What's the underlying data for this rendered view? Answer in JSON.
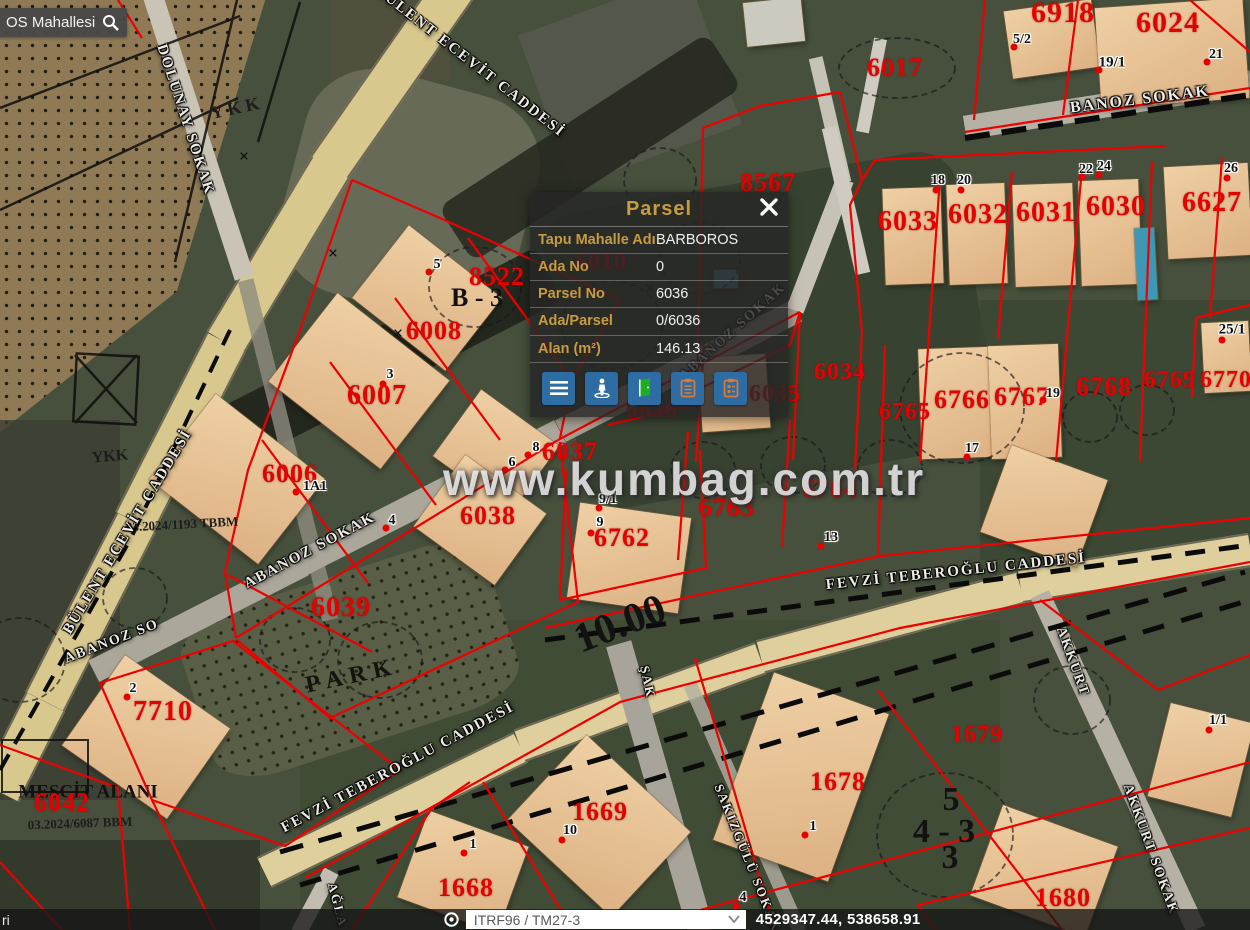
{
  "search": {
    "text": "OS Mahallesi"
  },
  "popup": {
    "title": "Parsel",
    "accent_color": "#c79b3f",
    "button_color": "#2e6da4",
    "rows": [
      {
        "label": "Tapu Mahalle Adı",
        "value": "BARBOROS"
      },
      {
        "label": "Ada No",
        "value": "0"
      },
      {
        "label": "Parsel No",
        "value": "6036"
      },
      {
        "label": "Ada/Parsel",
        "value": "0/6036"
      },
      {
        "label": "Alan (m²)",
        "value": "146.13"
      }
    ],
    "buttons": [
      {
        "name": "menu-button",
        "icon": "hamburger-icon"
      },
      {
        "name": "street-view-button",
        "icon": "pegman-icon"
      },
      {
        "name": "door-button",
        "icon": "door-icon"
      },
      {
        "name": "clipboard-button",
        "icon": "clipboard-icon"
      },
      {
        "name": "report-button",
        "icon": "clipboard-list-icon"
      }
    ]
  },
  "statusbar": {
    "left_fragment": "ri",
    "crs_selector": "ITRF96 / TM27-3",
    "coordinates": "4529347.44, 538658.91"
  },
  "watermark": {
    "text": "www.kumbag.com.tr"
  },
  "map": {
    "parcel_labels": [
      {
        "t": "6918",
        "x": 1063,
        "y": 13,
        "s": 30
      },
      {
        "t": "6024",
        "x": 1168,
        "y": 23,
        "s": 30
      },
      {
        "t": "6017",
        "x": 895,
        "y": 68,
        "s": 26
      },
      {
        "t": "8567",
        "x": 768,
        "y": 183,
        "s": 26
      },
      {
        "t": "6033",
        "x": 908,
        "y": 222,
        "s": 28
      },
      {
        "t": "6032",
        "x": 978,
        "y": 215,
        "s": 28
      },
      {
        "t": "6031",
        "x": 1046,
        "y": 213,
        "s": 28
      },
      {
        "t": "6030",
        "x": 1116,
        "y": 207,
        "s": 28
      },
      {
        "t": "6627",
        "x": 1212,
        "y": 203,
        "s": 28
      },
      {
        "t": "6010",
        "x": 601,
        "y": 262,
        "s": 24
      },
      {
        "t": "8522",
        "x": 497,
        "y": 277,
        "s": 26
      },
      {
        "t": "6008",
        "x": 434,
        "y": 331,
        "s": 26
      },
      {
        "t": "6007",
        "x": 377,
        "y": 396,
        "s": 28
      },
      {
        "t": "6006",
        "x": 290,
        "y": 474,
        "s": 26
      },
      {
        "t": "6034",
        "x": 840,
        "y": 372,
        "s": 24
      },
      {
        "t": "6035",
        "x": 775,
        "y": 394,
        "s": 24
      },
      {
        "t": "6036",
        "x": 652,
        "y": 410,
        "s": 24
      },
      {
        "t": "6765",
        "x": 905,
        "y": 412,
        "s": 24
      },
      {
        "t": "6766",
        "x": 962,
        "y": 400,
        "s": 26
      },
      {
        "t": "6767",
        "x": 1022,
        "y": 397,
        "s": 26
      },
      {
        "t": "6768",
        "x": 1104,
        "y": 387,
        "s": 26
      },
      {
        "t": "6769",
        "x": 1170,
        "y": 380,
        "s": 24
      },
      {
        "t": "6770",
        "x": 1226,
        "y": 380,
        "s": 24
      },
      {
        "t": "6037",
        "x": 570,
        "y": 452,
        "s": 26
      },
      {
        "t": "6038",
        "x": 488,
        "y": 516,
        "s": 26
      },
      {
        "t": "6762",
        "x": 622,
        "y": 538,
        "s": 26
      },
      {
        "t": "6763",
        "x": 727,
        "y": 508,
        "s": 26
      },
      {
        "t": "6764",
        "x": 830,
        "y": 489,
        "s": 26
      },
      {
        "t": "6039",
        "x": 341,
        "y": 608,
        "s": 28
      },
      {
        "t": "7710",
        "x": 163,
        "y": 712,
        "s": 28
      },
      {
        "t": "6042",
        "x": 62,
        "y": 803,
        "s": 26
      },
      {
        "t": "1669",
        "x": 600,
        "y": 812,
        "s": 26
      },
      {
        "t": "1668",
        "x": 466,
        "y": 888,
        "s": 26
      },
      {
        "t": "1678",
        "x": 838,
        "y": 782,
        "s": 26
      },
      {
        "t": "1679",
        "x": 977,
        "y": 735,
        "s": 24
      },
      {
        "t": "1680",
        "x": 1063,
        "y": 898,
        "s": 26
      }
    ],
    "house_numbers": [
      {
        "t": "5/2",
        "x": 1022,
        "y": 40,
        "s": 14
      },
      {
        "t": "21",
        "x": 1216,
        "y": 55,
        "s": 14
      },
      {
        "t": "19/1",
        "x": 1112,
        "y": 63,
        "s": 15
      },
      {
        "t": "18",
        "x": 938,
        "y": 181,
        "s": 14
      },
      {
        "t": "20",
        "x": 964,
        "y": 181,
        "s": 14
      },
      {
        "t": "22",
        "x": 1086,
        "y": 170,
        "s": 14
      },
      {
        "t": "24",
        "x": 1104,
        "y": 167,
        "s": 14
      },
      {
        "t": "26",
        "x": 1231,
        "y": 169,
        "s": 14
      },
      {
        "t": "25/1",
        "x": 1232,
        "y": 330,
        "s": 15
      },
      {
        "t": "19",
        "x": 1053,
        "y": 394,
        "s": 14
      },
      {
        "t": "17",
        "x": 972,
        "y": 449,
        "s": 14
      },
      {
        "t": "5",
        "x": 437,
        "y": 265,
        "s": 14
      },
      {
        "t": "3",
        "x": 390,
        "y": 375,
        "s": 14
      },
      {
        "t": "1A1",
        "x": 315,
        "y": 487,
        "s": 14
      },
      {
        "t": "8",
        "x": 536,
        "y": 448,
        "s": 14
      },
      {
        "t": "6",
        "x": 512,
        "y": 463,
        "s": 14
      },
      {
        "t": "9/1",
        "x": 608,
        "y": 500,
        "s": 14
      },
      {
        "t": "9",
        "x": 600,
        "y": 523,
        "s": 14
      },
      {
        "t": "13",
        "x": 831,
        "y": 538,
        "s": 14
      },
      {
        "t": "4",
        "x": 392,
        "y": 521,
        "s": 14
      },
      {
        "t": "2",
        "x": 133,
        "y": 689,
        "s": 14
      },
      {
        "t": "10",
        "x": 570,
        "y": 831,
        "s": 14
      },
      {
        "t": "1",
        "x": 473,
        "y": 845,
        "s": 14
      },
      {
        "t": "1",
        "x": 813,
        "y": 827,
        "s": 14
      },
      {
        "t": "1/1",
        "x": 1218,
        "y": 721,
        "s": 14
      },
      {
        "t": "4",
        "x": 743,
        "y": 898,
        "s": 14
      }
    ],
    "red_dots": [
      [
        1014,
        47
      ],
      [
        1207,
        62
      ],
      [
        1099,
        70
      ],
      [
        936,
        190
      ],
      [
        961,
        190
      ],
      [
        1082,
        177
      ],
      [
        1099,
        175
      ],
      [
        1227,
        178
      ],
      [
        1222,
        340
      ],
      [
        1043,
        400
      ],
      [
        967,
        457
      ],
      [
        429,
        272
      ],
      [
        383,
        384
      ],
      [
        296,
        492
      ],
      [
        528,
        455
      ],
      [
        505,
        470
      ],
      [
        599,
        508
      ],
      [
        591,
        533
      ],
      [
        821,
        546
      ],
      [
        386,
        528
      ],
      [
        127,
        697
      ],
      [
        562,
        840
      ],
      [
        464,
        853
      ],
      [
        805,
        835
      ],
      [
        1209,
        730
      ],
      [
        736,
        906
      ]
    ],
    "street_labels": [
      {
        "t": "DOLUNAY SOKAK",
        "x": 185,
        "y": 120,
        "r": 72,
        "s": 15
      },
      {
        "t": "BÜLENT ECEVİT CADDESİ",
        "x": 470,
        "y": 62,
        "r": 38,
        "s": 15
      },
      {
        "t": "BÜLENT ECEVİT CADDESİ",
        "x": 128,
        "y": 532,
        "r": -59,
        "s": 15
      },
      {
        "t": "BANOZ SOKAK",
        "x": 1140,
        "y": 100,
        "r": -7,
        "s": 16
      },
      {
        "t": "ABANOZ SOKAK",
        "x": 310,
        "y": 551,
        "r": -28,
        "s": 15
      },
      {
        "t": "ABANOZ SO",
        "x": 112,
        "y": 642,
        "r": -21,
        "s": 14
      },
      {
        "t": "ABANOZ SOKAK",
        "x": 733,
        "y": 332,
        "r": -42,
        "s": 14
      },
      {
        "t": "FEVZİ TEBEROĞLU CADDESİ",
        "x": 956,
        "y": 572,
        "r": -6,
        "s": 15
      },
      {
        "t": "FEVZİ TEBEROĞLU CADDESİ",
        "x": 398,
        "y": 768,
        "r": -28,
        "s": 15
      },
      {
        "t": "ŞAK",
        "x": 648,
        "y": 682,
        "r": 78,
        "s": 13
      },
      {
        "t": "AKKURT",
        "x": 1072,
        "y": 662,
        "r": 70,
        "s": 14
      },
      {
        "t": "AKKURT SOKAK",
        "x": 1150,
        "y": 850,
        "r": 70,
        "s": 14
      },
      {
        "t": "SAKIZGÜLÜ SOKAK",
        "x": 748,
        "y": 858,
        "r": 68,
        "s": 13
      },
      {
        "t": "AĞLA",
        "x": 338,
        "y": 905,
        "r": 75,
        "s": 13
      }
    ],
    "notes": [
      {
        "t": "PARK",
        "x": 352,
        "y": 676,
        "r": -12,
        "s": 24,
        "k": "park"
      },
      {
        "t": "B - 3",
        "x": 477,
        "y": 298,
        "r": 0,
        "s": 26,
        "k": "big"
      },
      {
        "t": "10.00",
        "x": 620,
        "y": 624,
        "r": -21,
        "s": 42,
        "k": "big"
      },
      {
        "t": "5",
        "x": 951,
        "y": 800,
        "r": 0,
        "s": 34,
        "k": "big"
      },
      {
        "t": "4 - 3",
        "x": 944,
        "y": 832,
        "r": 0,
        "s": 34,
        "k": "big"
      },
      {
        "t": "3",
        "x": 950,
        "y": 858,
        "r": 0,
        "s": 34,
        "k": "big"
      },
      {
        "t": "MESCİT ALANI",
        "x": 88,
        "y": 792,
        "r": 0,
        "s": 19,
        "k": "big"
      },
      {
        "t": "03.2024/1193 TBBM",
        "x": 182,
        "y": 524,
        "r": -3,
        "s": 13,
        "k": "note"
      },
      {
        "t": "03.2024/6087 BBM",
        "x": 80,
        "y": 823,
        "r": -2,
        "s": 13,
        "k": "note"
      },
      {
        "t": "YKK",
        "x": 110,
        "y": 457,
        "r": -5,
        "s": 16,
        "k": "note"
      },
      {
        "t": "Y K K",
        "x": 235,
        "y": 108,
        "r": -12,
        "s": 18,
        "k": "note"
      },
      {
        "t": "×",
        "x": 333,
        "y": 253,
        "r": 0,
        "s": 18,
        "k": "xmark"
      },
      {
        "t": "×",
        "x": 398,
        "y": 333,
        "r": 0,
        "s": 18,
        "k": "xmark"
      },
      {
        "t": "×",
        "x": 650,
        "y": 288,
        "r": 0,
        "s": 18,
        "k": "xmark"
      },
      {
        "t": "×",
        "x": 244,
        "y": 156,
        "r": 0,
        "s": 18,
        "k": "xmark"
      }
    ],
    "buildings": [
      {
        "x": 1008,
        "y": 5,
        "w": 88,
        "h": 68,
        "r": -8
      },
      {
        "x": 1098,
        "y": 3,
        "w": 148,
        "h": 100,
        "r": -4
      },
      {
        "x": 884,
        "y": 188,
        "w": 58,
        "h": 96,
        "r": -2
      },
      {
        "x": 948,
        "y": 184,
        "w": 58,
        "h": 100,
        "r": -2
      },
      {
        "x": 1014,
        "y": 184,
        "w": 60,
        "h": 102,
        "r": -2
      },
      {
        "x": 1080,
        "y": 180,
        "w": 60,
        "h": 105,
        "r": -2
      },
      {
        "x": 1166,
        "y": 165,
        "w": 84,
        "h": 92,
        "r": -3
      },
      {
        "x": 1203,
        "y": 322,
        "w": 47,
        "h": 70,
        "r": -3
      },
      {
        "x": 920,
        "y": 348,
        "w": 72,
        "h": 110,
        "r": -2
      },
      {
        "x": 990,
        "y": 345,
        "w": 70,
        "h": 113,
        "r": -2
      },
      {
        "x": 368,
        "y": 252,
        "w": 118,
        "h": 92,
        "r": 38
      },
      {
        "x": 288,
        "y": 325,
        "w": 142,
        "h": 112,
        "r": 38
      },
      {
        "x": 168,
        "y": 425,
        "w": 138,
        "h": 108,
        "r": 38
      },
      {
        "x": 448,
        "y": 410,
        "w": 96,
        "h": 82,
        "r": 36
      },
      {
        "x": 430,
        "y": 476,
        "w": 100,
        "h": 88,
        "r": 36
      },
      {
        "x": 573,
        "y": 510,
        "w": 112,
        "h": 96,
        "r": 8
      },
      {
        "x": 993,
        "y": 460,
        "w": 102,
        "h": 92,
        "r": 20
      },
      {
        "x": 82,
        "y": 682,
        "w": 128,
        "h": 110,
        "r": 35
      },
      {
        "x": 740,
        "y": 688,
        "w": 122,
        "h": 178,
        "r": 20
      },
      {
        "x": 528,
        "y": 768,
        "w": 142,
        "h": 116,
        "r": 43
      },
      {
        "x": 410,
        "y": 826,
        "w": 106,
        "h": 92,
        "r": 20
      },
      {
        "x": 983,
        "y": 823,
        "w": 122,
        "h": 96,
        "r": 20
      },
      {
        "x": 1158,
        "y": 712,
        "w": 86,
        "h": 96,
        "r": 14
      },
      {
        "x": 700,
        "y": 356,
        "w": 68,
        "h": 74,
        "r": -4
      },
      {
        "x": 745,
        "y": 0,
        "w": 58,
        "h": 44,
        "r": -6,
        "c": "#ccc9bf"
      },
      {
        "x": 1136,
        "y": 228,
        "w": 20,
        "h": 72,
        "r": -3,
        "c": "#3e97b5"
      },
      {
        "x": 714,
        "y": 270,
        "w": 24,
        "h": 18,
        "r": 0,
        "c": "#4796ac"
      }
    ]
  }
}
